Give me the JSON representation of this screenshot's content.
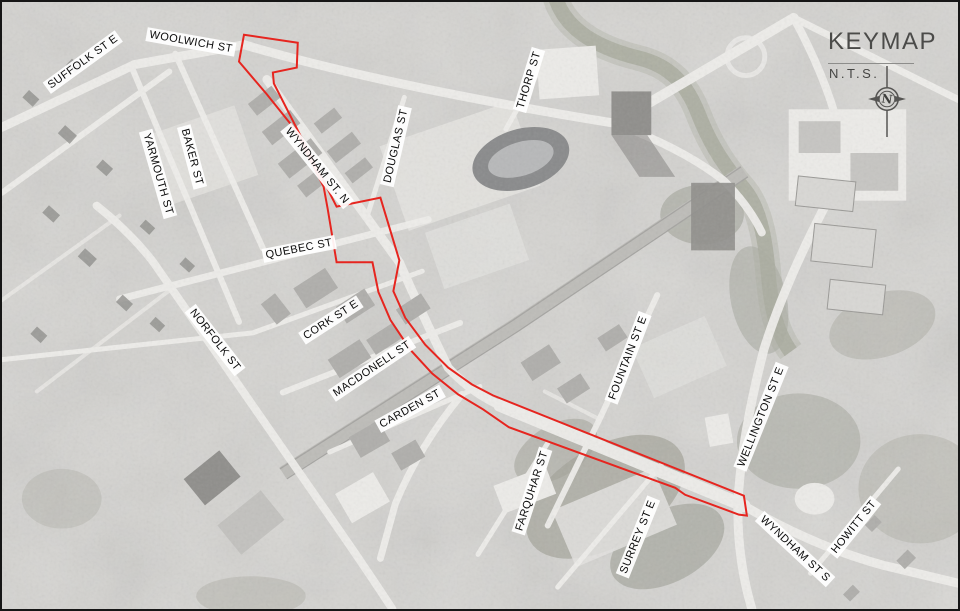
{
  "keymap": {
    "title": "KEYMAP",
    "scale_label": "N.T.S.",
    "compass_letter": "N"
  },
  "study_area": {
    "outline_color": "#e6251f"
  },
  "streets": {
    "suffolk": "SUFFOLK ST E",
    "woolwich": "WOOLWICH ST",
    "yarmouth": "YARMOUTH ST",
    "baker": "BAKER ST",
    "wyndham_n": "WYNDHAM ST. N",
    "douglas": "DOUGLAS ST",
    "thorp": "THORP ST",
    "quebec": "QUEBEC ST",
    "norfolk": "NORFOLK ST",
    "cork": "CORK ST E",
    "macdonell": "MACDONELL ST",
    "carden": "CARDEN ST",
    "fountain": "FOUNTAIN ST E",
    "wellington": "WELLINGTON ST E",
    "farquhar": "FARQUHAR ST",
    "surrey": "SURREY ST E",
    "wyndham_s": "WYNDHAM ST S",
    "howitt": "HOWITT ST"
  }
}
